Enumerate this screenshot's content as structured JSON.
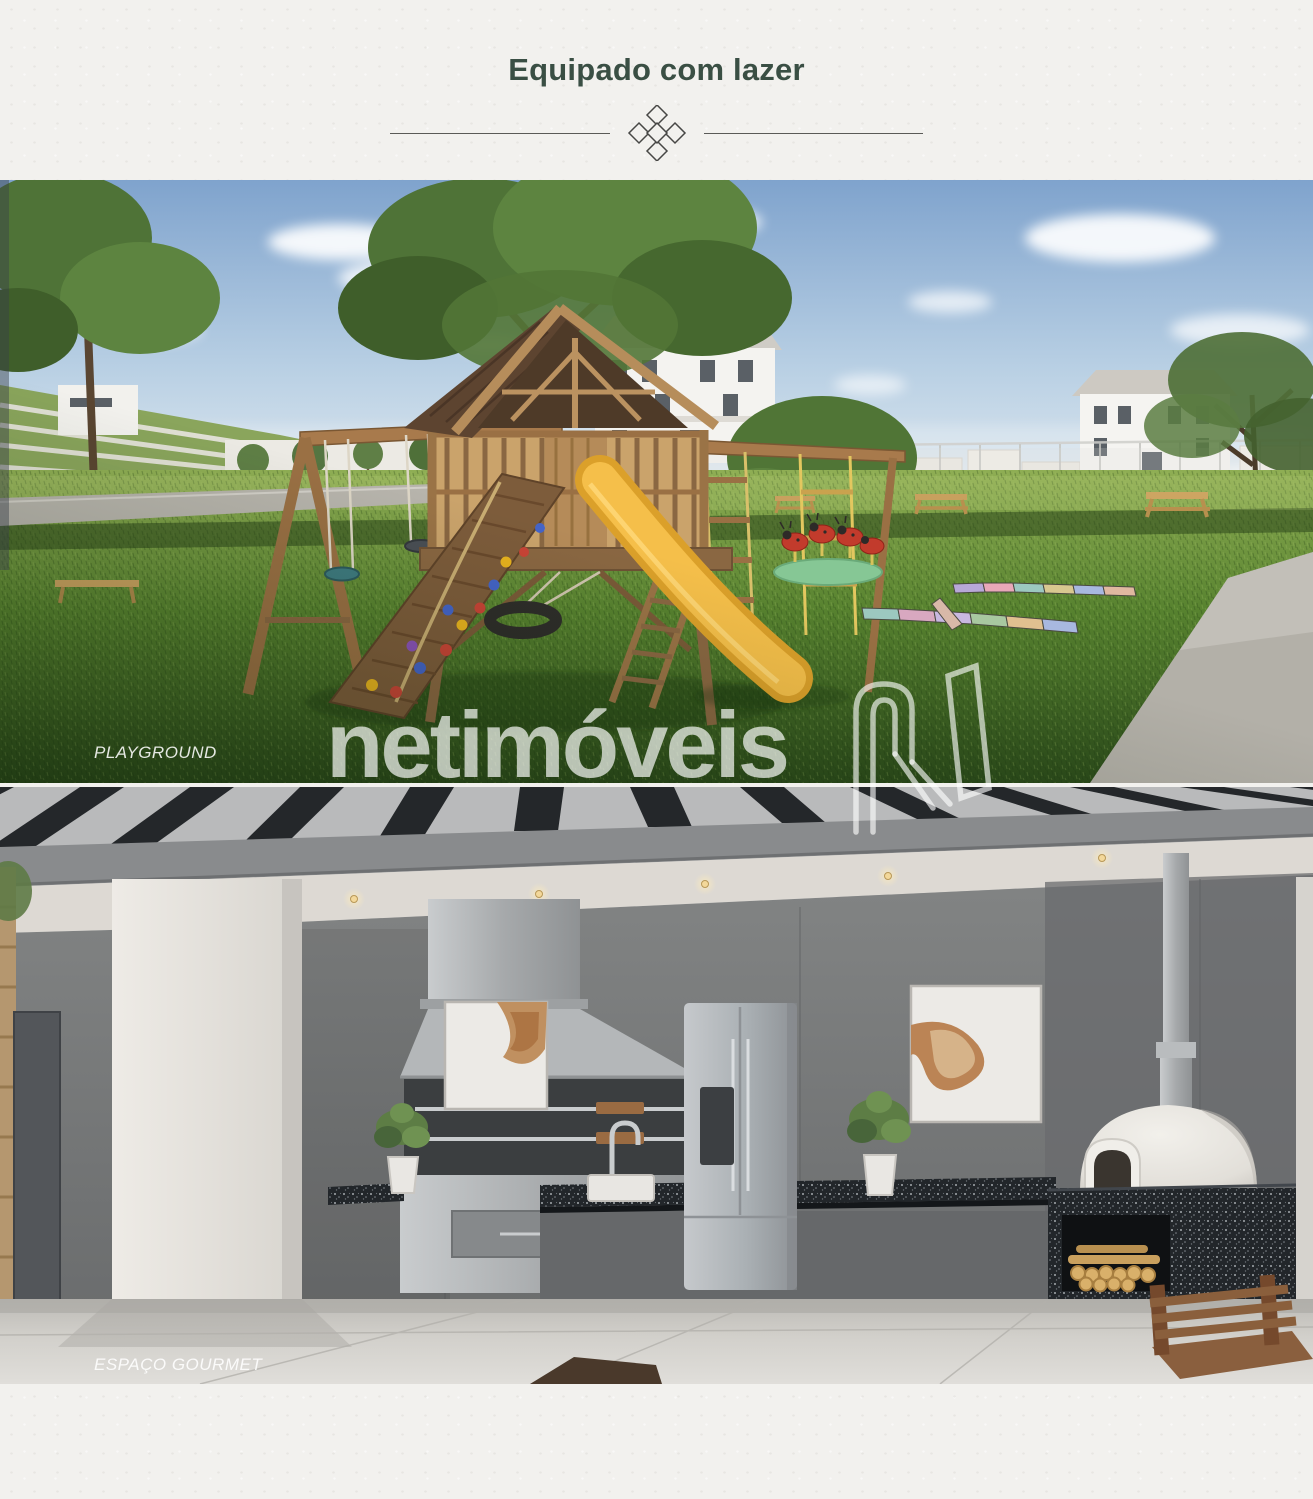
{
  "header": {
    "title": "Equipado com lazer",
    "title_color": "#3a4f44"
  },
  "divider": {
    "ornament": "five-diamond-cluster",
    "line_color": "#5a5a57"
  },
  "photos": [
    {
      "id": "playground",
      "label": "PLAYGROUND"
    },
    {
      "id": "espaco-gourmet",
      "label": "ESPAÇO GOURMET"
    }
  ],
  "watermark": {
    "text": "netimóveis",
    "logo": "netimoveis-n",
    "color": "#ffffff",
    "opacity": 0.68
  },
  "palette": {
    "page_background": "#f2f1ee",
    "heading_green": "#3a4f44",
    "sky_blue": "#7fa3cd",
    "grass_green": "#57822f",
    "slide_yellow": "#f3b93e",
    "wood_brown": "#9a7044",
    "pergola_black": "#24272a",
    "wall_gray": "#787a7a",
    "granite_black": "#22262a",
    "oven_cream": "#efede8"
  }
}
